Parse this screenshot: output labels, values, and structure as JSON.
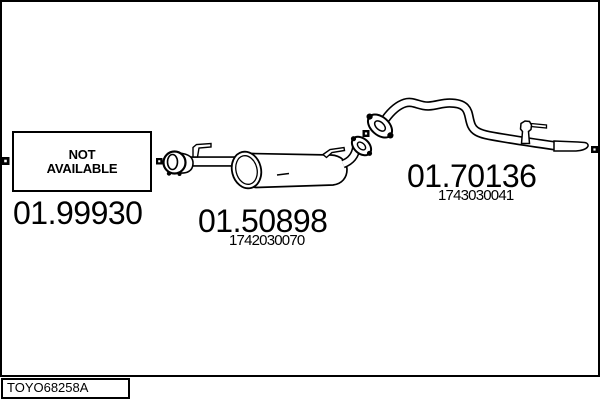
{
  "colors": {
    "line": "#000000",
    "background": "#ffffff"
  },
  "labels": {
    "not_available": [
      "NOT",
      "AVAILABLE"
    ],
    "left_code": "01.99930",
    "muffler_code": "01.50898",
    "muffler_oe": "1742030070",
    "tail_code": "01.70136",
    "tail_oe": "1743030041",
    "drawing_ref": "TOYO68258A"
  }
}
